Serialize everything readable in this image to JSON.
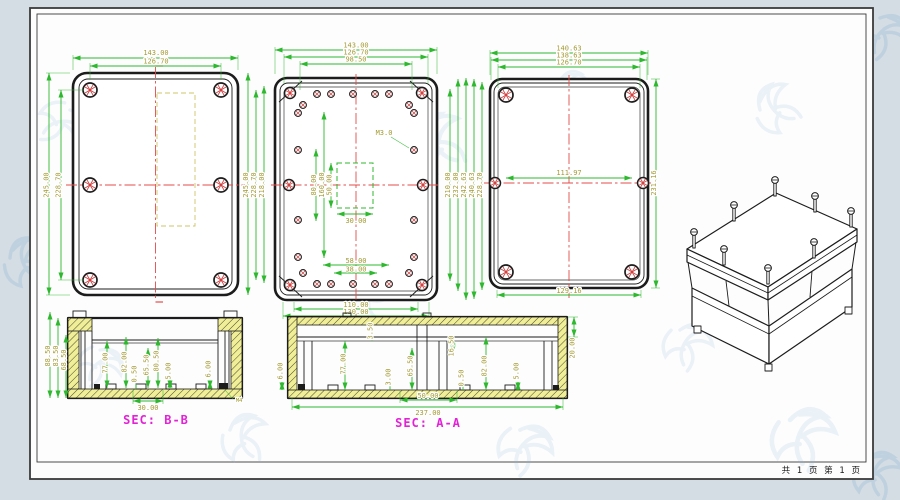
{
  "page": {
    "footer_pages": "共 1 页  第 1 页"
  },
  "colors": {
    "canvas_bg": "#d5dde4",
    "sheet_bg": "#fdfdfe",
    "object_line": "#1c1c1c",
    "dim_line": "#2db82d",
    "dim_text": "#a39a34",
    "centerline": "#e34b4b",
    "hidden_line": "#cfc468",
    "section_title": "#e322d6",
    "hatch_fill": "#f0ee96",
    "screw_hatch": "#d23c3c"
  },
  "views": {
    "lid_view": {
      "dim_width_outer": "143.00",
      "dim_width_inner": "126.70",
      "dim_height_outer": "245.00",
      "dim_height_inner": "228.70"
    },
    "shared_vertical_dims": [
      "245.00",
      "228.70",
      "218.00"
    ],
    "base_view": {
      "dims_top": [
        "143.00",
        "126.70",
        "98.50"
      ],
      "thread_callout": "M3.0",
      "dims_inner_vertical": [
        "80.00",
        "160.00",
        "50.00"
      ],
      "dim_inner_width": "30.00",
      "dims_bottom_inner": [
        "58.00",
        "38.00"
      ],
      "dims_bottom": [
        "110.00",
        "130.00"
      ],
      "dims_right": [
        "210.00",
        "232.00",
        "242.63",
        "240.63",
        "228.70"
      ]
    },
    "cover_view": {
      "dims_top": [
        "140.63",
        "138.63",
        "126.70"
      ],
      "dim_inner_width": "111.97",
      "dim_height": "231.16",
      "dim_bottom_width": "129.16"
    },
    "section_bb": {
      "title": "SEC: B-B",
      "dims_left": [
        "88.50",
        "83.50",
        "68.50"
      ],
      "dims_inner": [
        "77.00",
        "82.00",
        "0.50",
        "65.50",
        "80.50",
        "5.00",
        "6.00"
      ],
      "dim_bottom": "30.00",
      "insert_callout": "M4"
    },
    "section_aa": {
      "title": "SEC: A-A",
      "dims_inner": [
        "6.00",
        "77.00",
        "3.50",
        "65.50",
        "3.00",
        "16.50",
        "0.50",
        "82.00",
        "5.00"
      ],
      "dim_lid_height": "20.00",
      "dims_bottom": [
        "50.00",
        "237.00"
      ]
    }
  }
}
